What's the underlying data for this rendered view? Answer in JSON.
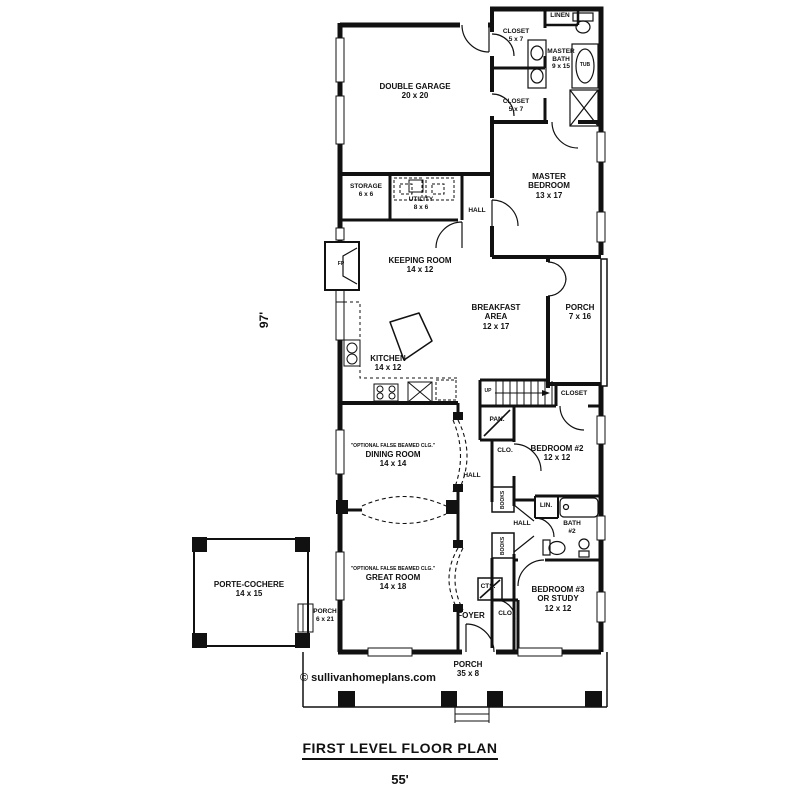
{
  "meta": {
    "title": "FIRST LEVEL FLOOR PLAN",
    "width_dim": "55'",
    "height_dim": "97'",
    "copyright": "© sullivanhomeplans.com"
  },
  "rooms": {
    "double_garage": {
      "label": "DOUBLE GARAGE",
      "dims": "20 x 20"
    },
    "closet_top": {
      "label": "CLOSET",
      "dims": "5 x 7"
    },
    "master_bath": {
      "l1": "MASTER",
      "l2": "BATH",
      "dims": "9 x 15"
    },
    "linen": {
      "label": "LINEN"
    },
    "closet_mid": {
      "label": "CLOSET",
      "dims": "5 x 7"
    },
    "master_bedroom": {
      "l1": "MASTER",
      "l2": "BEDROOM",
      "dims": "13 x 17"
    },
    "storage": {
      "label": "STORAGE",
      "dims": "6 x 6"
    },
    "utility": {
      "label": "UTILITY",
      "dims": "8 x 6"
    },
    "hall_top": {
      "label": "HALL"
    },
    "keeping_room": {
      "label": "KEEPING ROOM",
      "dims": "14 x 12"
    },
    "breakfast_area": {
      "l1": "BREAKFAST",
      "l2": "AREA",
      "dims": "12 x 17"
    },
    "porch_right": {
      "label": "PORCH",
      "dims": "7 x 16"
    },
    "kitchen": {
      "label": "KITCHEN",
      "dims": "14 x 12"
    },
    "stairs": {
      "label": "UP"
    },
    "closet_stairs": {
      "label": "CLOSET"
    },
    "pantry": {
      "label": "PAN."
    },
    "dining_room": {
      "note": "\"OPTIONAL FALSE BEAMED CLG.\"",
      "label": "DINING ROOM",
      "dims": "14 x 14"
    },
    "hall_mid": {
      "label": "HALL"
    },
    "clo_1": {
      "label": "CLO."
    },
    "bedroom_2": {
      "label": "BEDROOM #2",
      "dims": "12 x 12"
    },
    "books_1": {
      "label": "BOOKS"
    },
    "linen_2": {
      "label": "LIN."
    },
    "hall_lower": {
      "label": "HALL"
    },
    "bath_2": {
      "l1": "BATH",
      "l2": "#2"
    },
    "books_2": {
      "label": "BOOKS"
    },
    "great_room": {
      "note": "\"OPTIONAL FALSE BEAMED CLG.\"",
      "label": "GREAT ROOM",
      "dims": "14 x 18"
    },
    "cts": {
      "label": "CTS."
    },
    "clo_2": {
      "label": "CLO."
    },
    "bedroom_3": {
      "l1": "BEDROOM #3",
      "l2": "OR STUDY",
      "dims": "12 x 12"
    },
    "foyer": {
      "label": "FOYER"
    },
    "porch_bottom": {
      "label": "PORCH",
      "dims": "35 x 8"
    },
    "porte_cochere": {
      "label": "PORTE-COCHERE",
      "dims": "14 x 15"
    },
    "porch_left": {
      "label": "PORCH",
      "dims": "6 x 21"
    },
    "fireplace": {
      "label": "FP"
    },
    "tub": {
      "label": "TUB"
    }
  }
}
